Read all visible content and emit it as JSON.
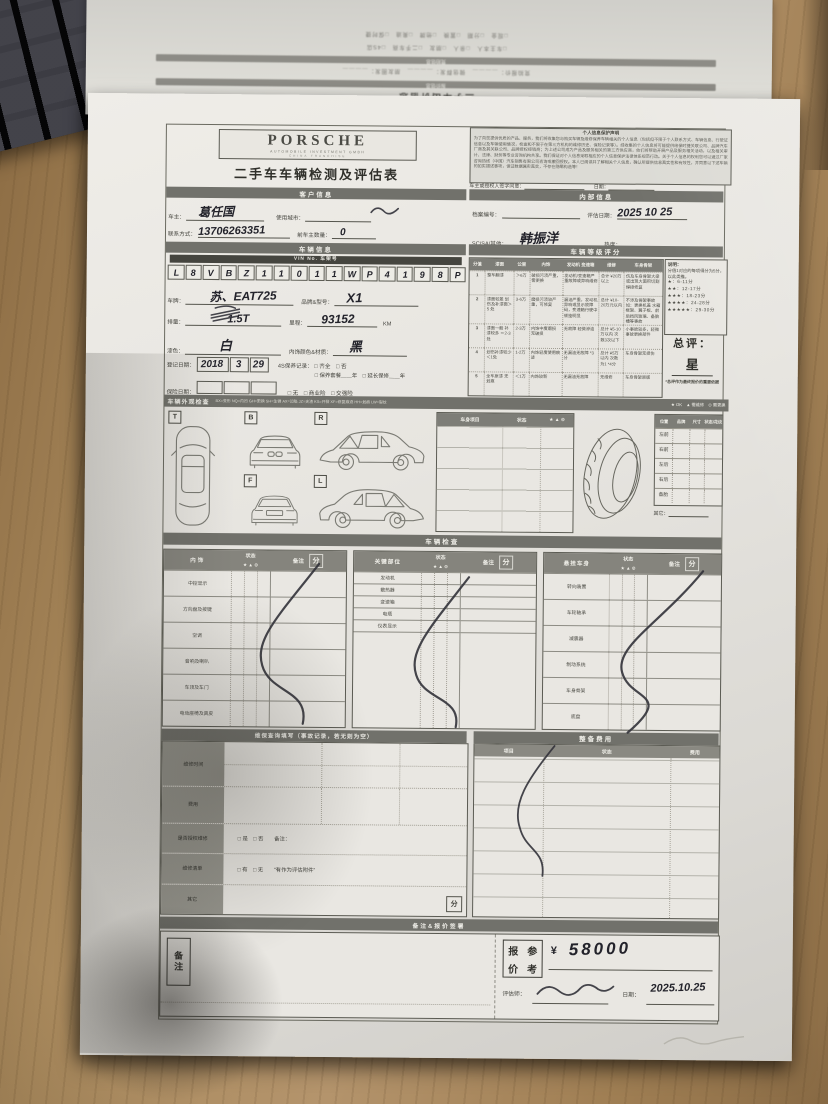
{
  "photo": {
    "flipped_page": {
      "title": "二手车出价信息",
      "bar1": "报价信息",
      "bar2": "竞拍信息",
      "fields_row": "竞拍报价：＿＿＿＿　微信群发：＿＿＿＿　朋友圈发：＿＿＿＿",
      "checks_row1": "□车主本人　□亲人　□朋友　□二手车商　□4S店",
      "checks_row2": "□现金　□分期　□置换　□他牌　□奥迪　□保时捷"
    }
  },
  "form": {
    "header": {
      "brand": "PORSCHE",
      "brand_sub": "AUTOMOBILE INVESTMENT GMBH",
      "brand_sub2": "CHINA FRANCHISE",
      "title": "二手车车辆检测及评估表",
      "privacy_title": "个人信息保护声明",
      "privacy_text": "为了向您提供优质的产品、服务，我们将收集您与购买车辆及维修保养车辆相关的个人信息（包括但不限于个人联系方式、车辆信息、行驶证信息以及车辆使用情况，检查和不限于在第三方机构的维修历史、保险记录等）。经收集的个人信息将可能提供给保时捷关联公司、品牌汽车厂商及其关联公司、品牌授权经销商；为上述公司成为产品及服务相关的第三方供应商，他们将帮助开展产品及服务相关活动，以及相关审计、法律、财务等专业咨询机构共享。我们保证对个人信息采取相应的个人信息保护法律体系规范行动。关于个人信息的权利您可以通过厂家咨询热线（中国）汽车销售有限公司咨询或撤回授权。本人已阅读并了解相关个人信息，确认所提供信息真实性和有效性，并同意以下述车辆的如实描述事项，保证数据属实真实，不存在隐瞒构造等！",
      "sign_label": "车主或授权人签字同意：",
      "date_label": "日期："
    },
    "customer": {
      "bar": "客户信息",
      "owner_label": "车主：",
      "owner_value": "葛任国",
      "city_label": "使用城市：",
      "contact_label": "联系方式：",
      "contact_value": "13706263351",
      "prev_owner_label": "前车主数量：",
      "prev_owner_value": "0"
    },
    "internal": {
      "bar": "内部信息",
      "file_label": "档案编号：",
      "eval_date_label": "评估日期：",
      "eval_date_value": "2025  10  25",
      "scsa_label": "SC/SA/其他：",
      "scsa_value": "韩振洋",
      "heat_label": "热度："
    },
    "vehicle": {
      "bar": "车辆信息",
      "vin_label": "VIN No. 车架号",
      "vin_chars": [
        "L",
        "8",
        "V",
        "B",
        "Z",
        "1",
        "1",
        "0",
        "1",
        "1",
        "W",
        "P",
        "4",
        "1",
        "9",
        "8",
        "P"
      ],
      "plate_label": "车牌：",
      "plate_value": "苏、EAT725",
      "brand_label": "品牌&型号：",
      "brand_value": "X1",
      "disp_label": "排量：",
      "disp_value": "1.5T",
      "mileage_label": "里程：",
      "mileage_value": "93152",
      "mileage_unit": "KM",
      "paint_label": "漆色：",
      "paint_value": "白",
      "interior_label": "内饰颜色&材质：",
      "interior_value": "黑",
      "reg_label": "登记日期：",
      "reg_parts": [
        "2018",
        "3",
        "29"
      ],
      "maint_label": "4S保养记录：",
      "maint_opts1": "□ 齐全　□ 否",
      "maint_opts2": "□ 保养套餐＿＿年　□ 延长保修＿＿年",
      "ins_label": "保险日期：",
      "ins_opts": "□ 无　□ 商业险　□ 交强险"
    },
    "rating": {
      "bar": "车辆等级评分",
      "headers": [
        "分值",
        "漆面",
        "公里",
        "内饰",
        "发动机 变速箱",
        "维修",
        "车身骨架"
      ],
      "rows": [
        [
          "1",
          "整车翻漆",
          "＞6万",
          "破损污渍严重，需更换",
          "发动机/变速箱严重故障或异响维修",
          "总计 ¥20万以上",
          "伤及车身骨架大梁或出现大面积切割焊接修复"
        ],
        [
          "2",
          "漆面较差 划伤及补漆面＞5 处",
          "3-6万",
          "磨损污渍较严重，可修复",
          "漏油严重，发动机异响或显示故障码，变速箱行驶中顿挫明显",
          "总计 ¥10-20万元以内",
          "不涉及骨架事故如：更换机盖 水箱框架、翼子板、前后挡风玻璃、备胎槽等事故"
        ],
        [
          "3",
          "漆面一般 补漆较多 ＝2-3处",
          "2-3万",
          "内饰中度磨损 无破损",
          "无故障 轻微渗油",
          "总计 ¥5-10万以内 次数3次以下",
          "小事故较多，轻微事故更换部件"
        ],
        [
          "4",
          "划伤补漆较少 ＜1处",
          "1-2万",
          "内饰轻度使用痕迹",
          "无漏油无故障 *3分",
          "总计 ¥5万以内 次数为1 *4分",
          "车身骨架无损伤"
        ],
        [
          "5",
          "全车原漆 无划痕",
          "＜1万",
          "内饰较新",
          "无漏油无故障",
          "无维修",
          "车身骨架原版"
        ]
      ],
      "note_title": "说明：",
      "note_text": "分值1对应的每项得分为5分，以此类推。",
      "stars": [
        "★：6-11分",
        "★★：12-17分",
        "★★★：18-23分",
        "★★★★：24-28分",
        "★★★★★：29-30分"
      ],
      "overall_label": "总评：",
      "overall_value": "星",
      "footnote": "*总评作为最终报价的重要依据"
    },
    "exterior": {
      "bar": "车辆外观检查",
      "legend": "BX=变形 NQ=内凹 GH=更换 SH=生锈 AX=凹陷 JZ=夹渣 KS=开裂 XF=修复痕迹 HH=划痕 LW=裂纹",
      "legend2": "★ OK　▲ 需维修　⊙ 需更换",
      "views": [
        "T",
        "B",
        "R",
        "F",
        "L"
      ],
      "body_table": {
        "headers": [
          "车身项目",
          "状态",
          "★ ▲ ⊙"
        ]
      },
      "tire_table": {
        "headers": [
          "位置",
          "品牌",
          "尺寸",
          "状态/花纹"
        ],
        "rows": [
          "左前",
          "右前",
          "左后",
          "右后",
          "备胎"
        ],
        "other_label": "其它："
      }
    },
    "check": {
      "bar": "车辆检查",
      "status_label": "状态",
      "note_label": "备注",
      "score_label": "分",
      "icons": "★ ▲ ⊙",
      "tables": [
        {
          "title": "内饰",
          "rows": [
            "中控显示",
            "方向盘及按键",
            "空调",
            "音响及喇叭",
            "车顶及车门",
            "电动座椅及真皮"
          ]
        },
        {
          "title": "关键部位",
          "rows": [
            "发动机",
            "散热器",
            "变速箱",
            "电瓶",
            "仪表显示"
          ]
        },
        {
          "title": "悬挂车身",
          "rows": [
            "转向装置",
            "车轮轴承",
            "减震器",
            "制动系统",
            "车身骨架",
            "底盘"
          ]
        }
      ]
    },
    "maintenance": {
      "bar": "维保查询填写（事故记录，若无则为空）",
      "rows": [
        "维修时间",
        "费用",
        "是否授权维修",
        "维修清单",
        "其它"
      ],
      "auth_opts": "□ 是　□ 否　　备注：",
      "list_opts": "□ 有　□ 无　　“有作为评估附件”",
      "score_label": "分"
    },
    "recondition": {
      "bar": "整备费用",
      "headers": [
        "项目",
        "状态",
        "费用"
      ]
    },
    "footer": {
      "bar": "备注&报价签署",
      "note_chars": "备注",
      "quote_chars": [
        "报",
        "参",
        "价",
        "考"
      ],
      "currency": "¥",
      "price": "58000",
      "assessor_label": "评估师：",
      "date_label": "日期：",
      "date_value": "2025.10.25"
    }
  }
}
